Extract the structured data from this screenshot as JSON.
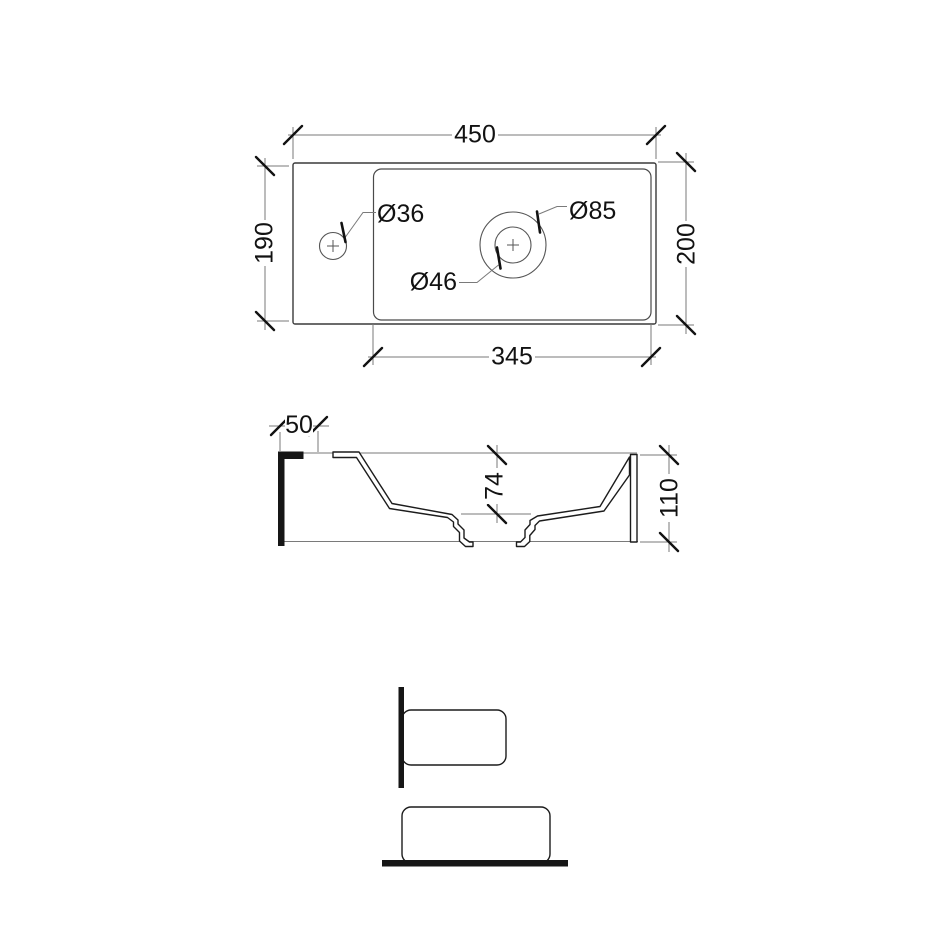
{
  "drawing": {
    "type": "washbasin-technical-drawing",
    "colors": {
      "background": "#ffffff",
      "outline": "#3a3a3a",
      "cut_line": "#161616",
      "dimension_line": "#7a7a7a",
      "text": "#121212"
    },
    "plan_view": {
      "overall_width": "450",
      "left_depth": "190",
      "right_depth": "200",
      "basin_width": "345",
      "tap_hole_diameter": "Ø36",
      "waste_hole_diameter": "Ø46",
      "waste_recess_diameter": "Ø85"
    },
    "section_view": {
      "shelf_width": "50",
      "basin_inner_depth": "74",
      "overall_height": "110"
    }
  }
}
